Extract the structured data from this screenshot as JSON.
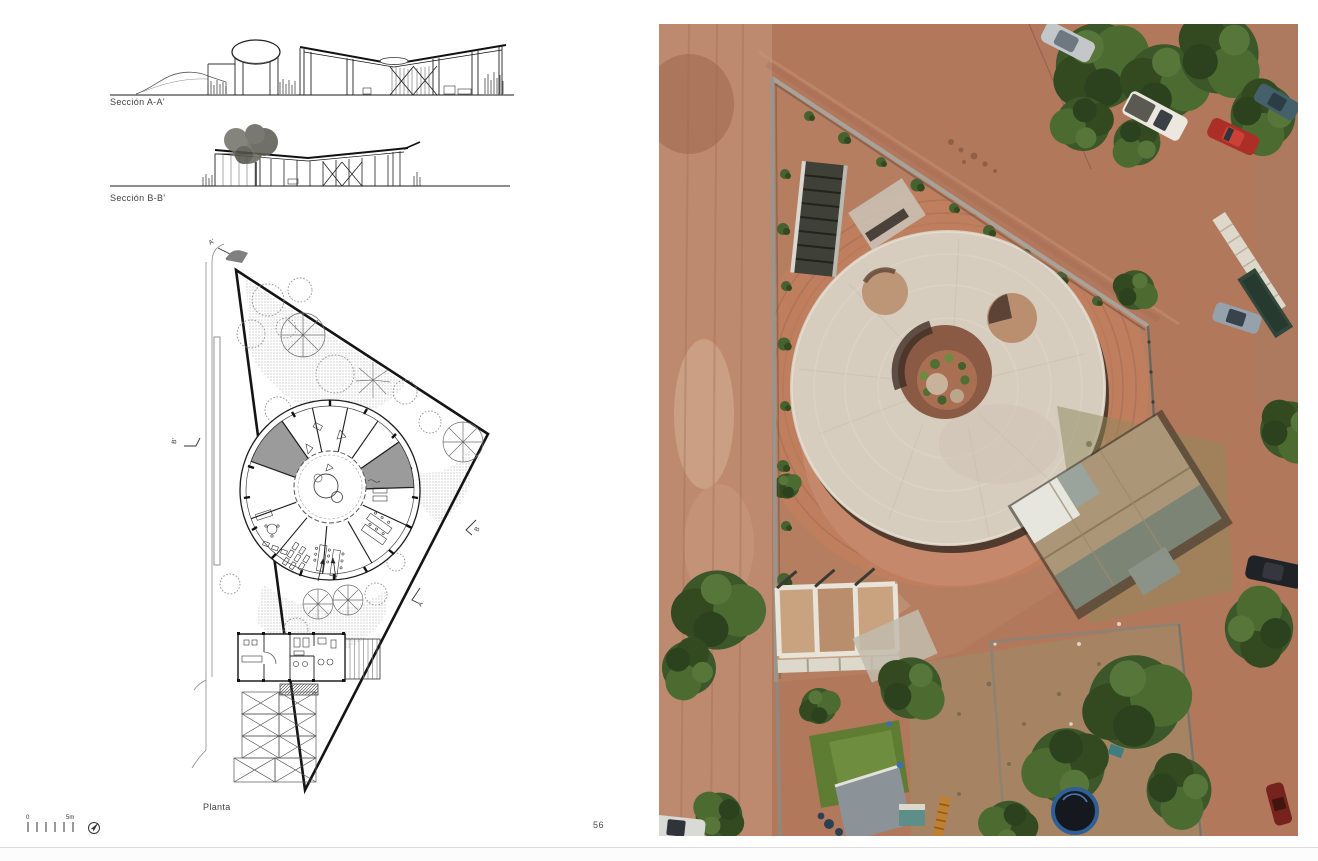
{
  "document": {
    "page_number": "56"
  },
  "figures": {
    "section_aa_label": "Sección A-A'",
    "section_bb_label": "Sección B-B'",
    "plan_label": "Planta"
  },
  "plan_markers": {
    "a_prime": "A'",
    "a": "A",
    "b_prime": "B'",
    "b": "B"
  },
  "scale_bar": {
    "zero": "0",
    "five_meters": "5m"
  },
  "icons": {
    "north_arrow": "north-arrow-icon"
  },
  "photo": {
    "subject": "aerial-view-circular-building-red-earth-site",
    "colors": {
      "earth": "#b2785c",
      "road": "#bd8a70",
      "roof_disc": "#d7cdbf",
      "terrace": "#c5886a",
      "trees": "#3c5729",
      "lawn": "#5f7c33",
      "wall": "#a8a39a",
      "metal_roof": "#ac9678"
    }
  }
}
